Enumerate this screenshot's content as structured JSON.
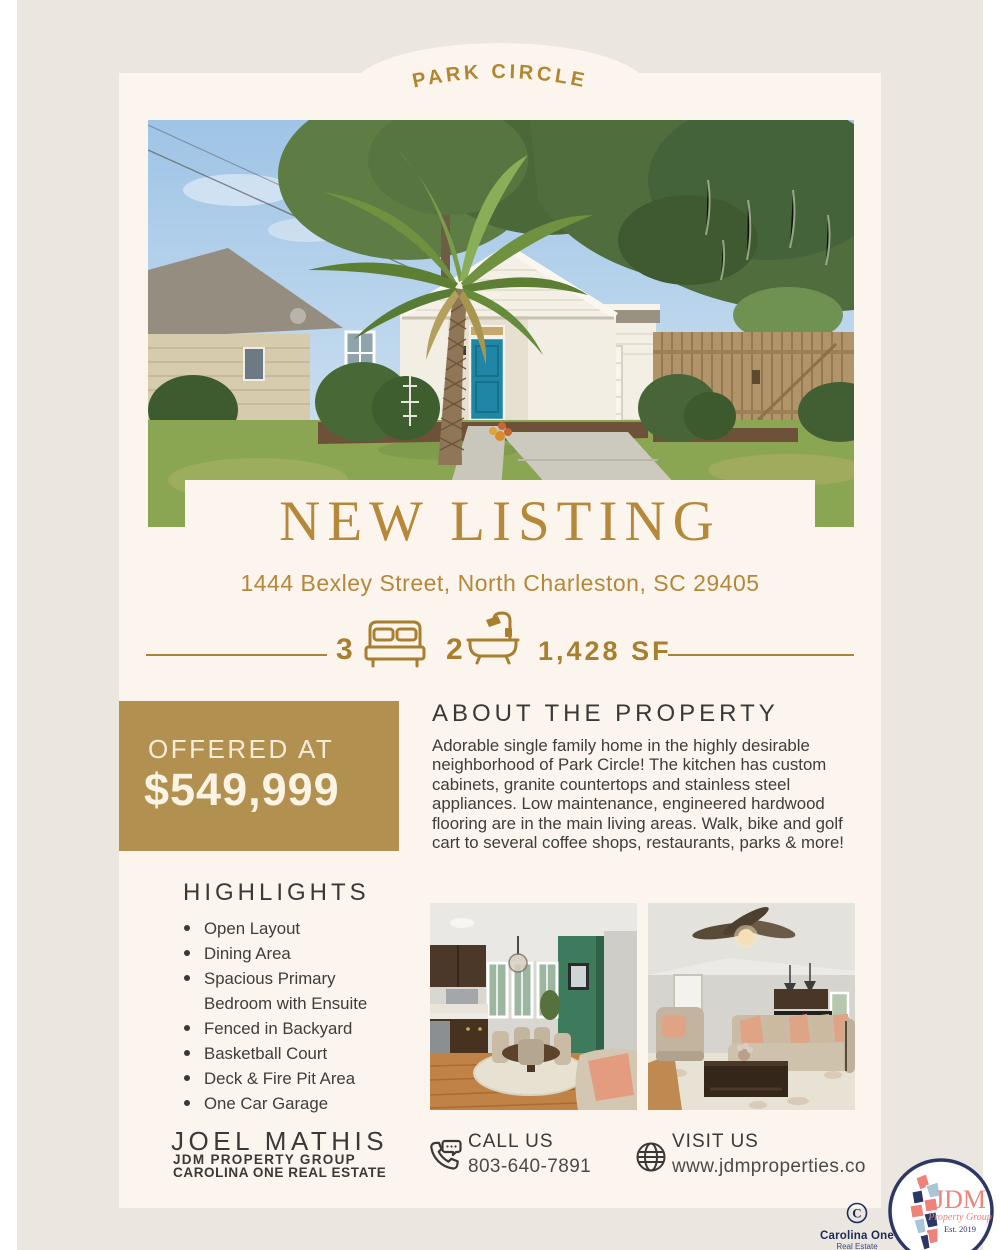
{
  "banner": {
    "neighborhood": "PARK CIRCLE"
  },
  "listing": {
    "title": "NEW LISTING",
    "address": "1444 Bexley Street, North Charleston, SC 29405",
    "beds": "3",
    "baths": "2",
    "sqft": "1,428 SF"
  },
  "price": {
    "label": "OFFERED AT",
    "amount": "$549,999"
  },
  "about": {
    "heading": "ABOUT THE PROPERTY",
    "body": "Adorable single family home in the highly desirable neighborhood of Park Circle! The kitchen has custom cabinets, granite countertops and stainless steel appliances. Low maintenance, engineered hardwood flooring are in the main living areas. Walk, bike and golf cart to several coffee shops, restaurants, parks & more!"
  },
  "highlights": {
    "heading": "HIGHLIGHTS",
    "items": [
      "Open Layout",
      "Dining Area",
      "Spacious Primary Bedroom with Ensuite",
      "Fenced in Backyard",
      "Basketball Court",
      "Deck & Fire Pit Area",
      "One Car Garage"
    ]
  },
  "agent": {
    "name": "JOEL MATHIS",
    "team": "JDM PROPERTY GROUP",
    "brokerage": "CAROLINA ONE REAL ESTATE"
  },
  "contact": {
    "call": {
      "label": "CALL US",
      "value": "803-640-7891"
    },
    "visit": {
      "label": "VISIT US",
      "value": "www.jdmproperties.co"
    }
  },
  "logos": {
    "carolina_one": {
      "initial": "C",
      "name": "Carolina One",
      "sub": "Real Estate"
    },
    "jdm": {
      "name": "JDM",
      "sub": "Property Group",
      "est": "Est. 2019"
    }
  },
  "colors": {
    "gold_text": "#b5883a",
    "gold_icon": "#a87f2e",
    "gold_block": "#b29150",
    "cream": "#fcf5ed",
    "beige": "#ebe6df",
    "ink": "#3a3937",
    "navy": "#273263",
    "coral": "#ee837a"
  }
}
